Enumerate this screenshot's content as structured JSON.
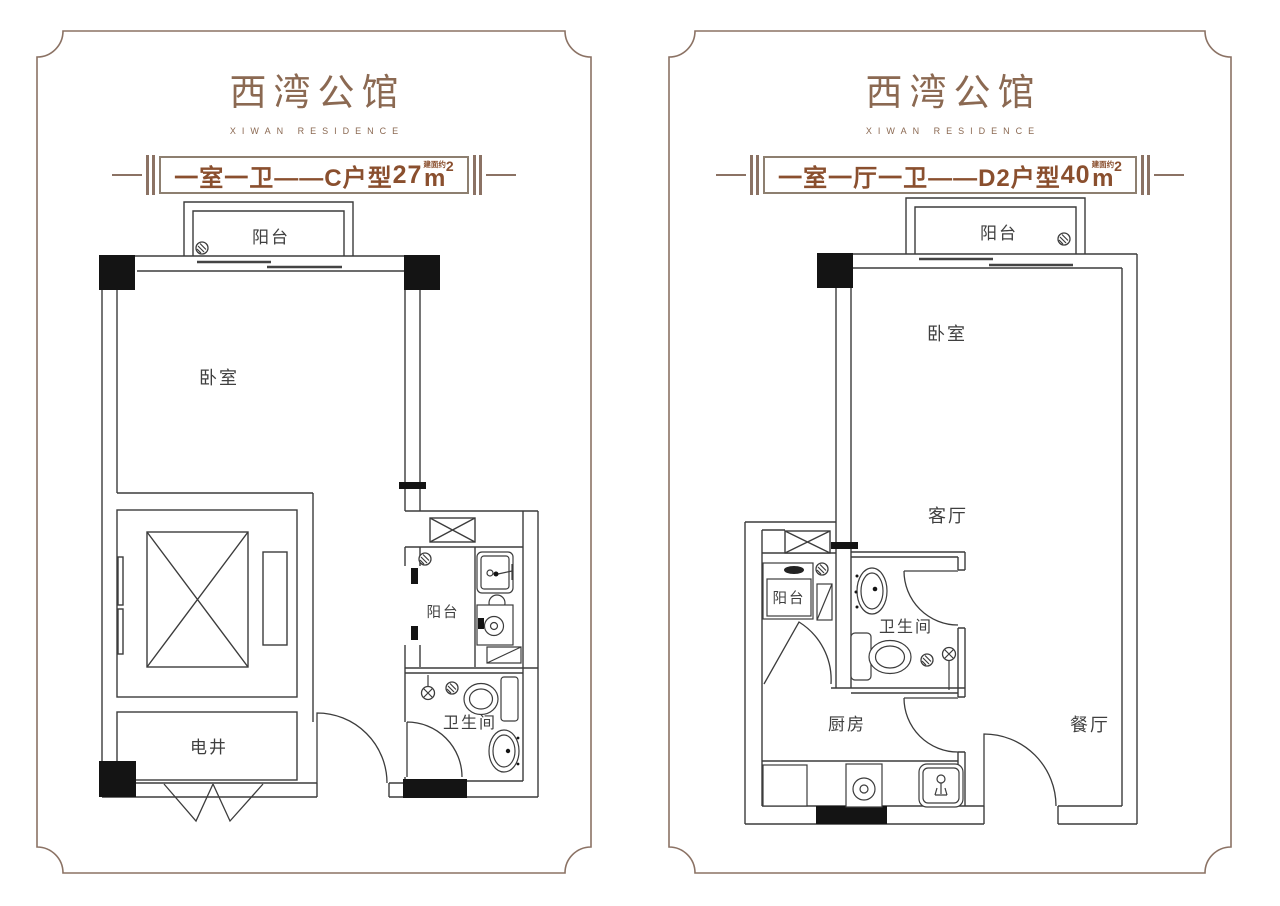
{
  "colors": {
    "frame": "#8b7264",
    "brand": "#8b6952",
    "banner_text": "#8a4f2e",
    "banner_border": "#8d7f70",
    "plan_line": "#3c3c3c",
    "plan_black": "#141414",
    "label": "#3f3f3f"
  },
  "panels": [
    {
      "logo": {
        "title": "西湾公馆",
        "subtitle": "XIWAN RESIDENCE"
      },
      "banner": {
        "prefix": "一室一卫——C户型",
        "area": "27",
        "area_note": "建面约",
        "unit": "m",
        "unit_sup": "2"
      },
      "rooms": {
        "balcony_top": "阳台",
        "bedroom": "卧室",
        "utility_shaft": "电井",
        "balcony_side": "阳台",
        "bathroom": "卫生间"
      }
    },
    {
      "logo": {
        "title": "西湾公馆",
        "subtitle": "XIWAN RESIDENCE"
      },
      "banner": {
        "prefix": "一室一厅一卫——D2户型",
        "area": "40",
        "area_note": "建面约",
        "unit": "m",
        "unit_sup": "2"
      },
      "rooms": {
        "balcony_top": "阳台",
        "bedroom": "卧室",
        "living": "客厅",
        "balcony_side": "阳台",
        "bathroom": "卫生间",
        "kitchen": "厨房",
        "dining": "餐厅"
      }
    }
  ]
}
